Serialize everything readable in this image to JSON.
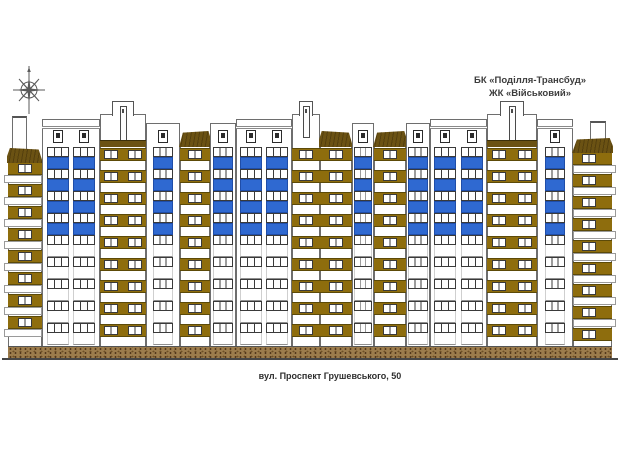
{
  "drawing": {
    "developer": "БК «Поділля-Трансбуд»",
    "complex": "ЖК «Військовий»",
    "address": "вул. Проспект Грушевського, 50"
  },
  "icons": {
    "compass": "compass-rose-icon"
  },
  "colors": {
    "brown_band": "#8e6d0d",
    "band_edge": "#5c4a08",
    "blue_panel": "#2f69d1",
    "blue_border": "#1f4da8",
    "roof_brown": "#6b5213",
    "roof_hatch": "rgba(40,28,4,0.35)",
    "plinth": "#9c7c4c",
    "plinth_dot1": "#53381c",
    "plinth_dot2": "#6e5026",
    "outline": "#6e6e6e",
    "window_frame": "#3a3a3a",
    "slab_edge": "#9a9a9a",
    "ground": "#474747",
    "white": "#ffffff"
  },
  "building": {
    "floors": 9,
    "blue_floors": 4,
    "floors_top": 147,
    "floor_pitch": 22,
    "base_y": 346,
    "plinth_h": 13,
    "ground_y": 358,
    "x0": 8,
    "x1": 612,
    "sections": [
      {
        "type": "endcap",
        "x": 8,
        "w": 34,
        "side": "left",
        "top": 162
      },
      {
        "type": "tower",
        "x": 42,
        "w": 58,
        "attics": 2
      },
      {
        "type": "gable",
        "x": 100,
        "w": 46,
        "pairs": 2
      },
      {
        "type": "bcol",
        "x": 146,
        "w": 34,
        "attic": true
      },
      {
        "type": "brown",
        "x": 180,
        "w": 30,
        "slope": "right"
      },
      {
        "type": "bcol",
        "x": 210,
        "w": 26,
        "attic": true
      },
      {
        "type": "tower",
        "x": 236,
        "w": 56,
        "attics": 2
      },
      {
        "type": "gable",
        "x": 292,
        "w": 28,
        "pairs": 1
      },
      {
        "type": "brown",
        "x": 320,
        "w": 32,
        "slope": "left"
      },
      {
        "type": "bcol",
        "x": 352,
        "w": 22,
        "attic": true
      },
      {
        "type": "brown",
        "x": 374,
        "w": 32,
        "slope": "right"
      },
      {
        "type": "bcol",
        "x": 406,
        "w": 24,
        "attic": true
      },
      {
        "type": "tower",
        "x": 430,
        "w": 57,
        "attics": 2
      },
      {
        "type": "gable",
        "x": 487,
        "w": 50,
        "pairs": 2
      },
      {
        "type": "tower",
        "x": 537,
        "w": 36,
        "attics": 1
      },
      {
        "type": "endcap",
        "x": 573,
        "w": 39,
        "side": "right",
        "top": 152
      }
    ]
  }
}
